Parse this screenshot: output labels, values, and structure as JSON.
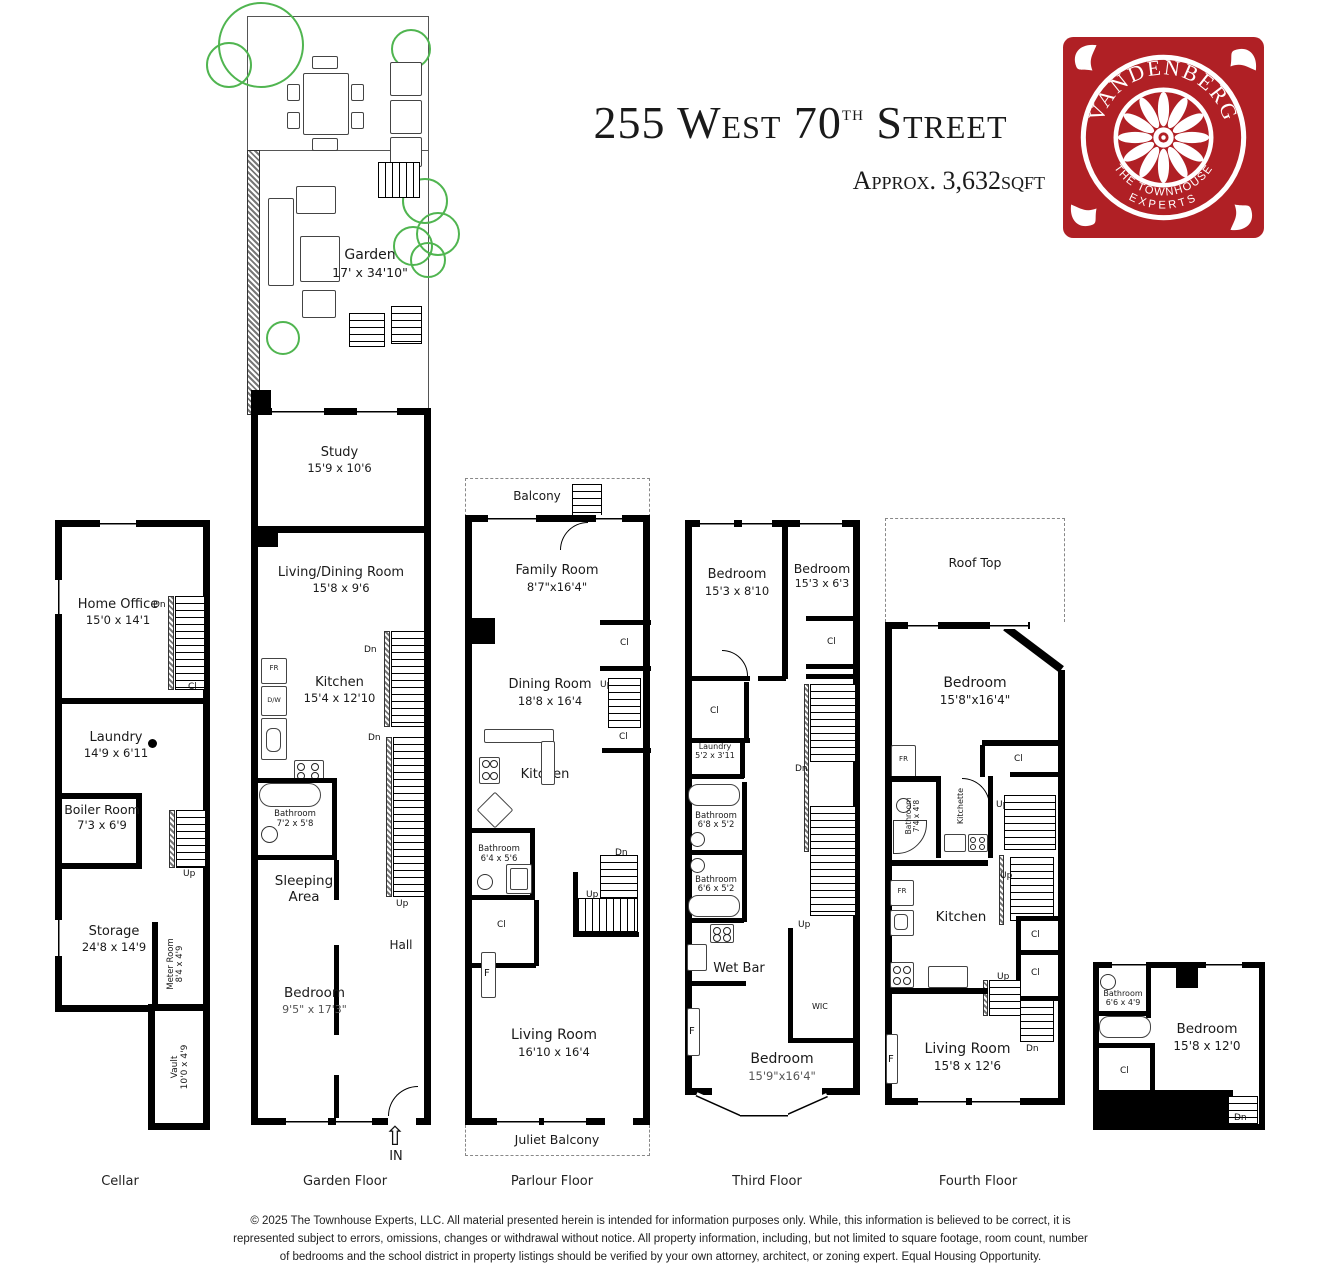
{
  "header": {
    "title_num": "255 West 70",
    "title_sup": "th",
    "title_rest": " Street",
    "subtitle": "Approx. 3,632sqft"
  },
  "logo": {
    "brand": "VANDENBERG",
    "tagline_top": "THE TOWNHOUSE",
    "tagline_bottom": "EXPERTS",
    "bg": "#b02025"
  },
  "garden": {
    "name": "Garden",
    "dims": "17' x 34'10\""
  },
  "labels": {
    "dn": "Dn",
    "up": "Up",
    "cl": "Cl",
    "f": "F",
    "fr": "FR",
    "dw": "D/W",
    "wic": "WIC",
    "entry": "IN"
  },
  "icons": {
    "entry_arrow": "⇧"
  },
  "cellar": {
    "floor_label": "Cellar",
    "home_office": {
      "n": "Home Office",
      "d": "15'0 x 14'1"
    },
    "laundry": {
      "n": "Laundry",
      "d": "14'9 x 6'11"
    },
    "boiler": {
      "n": "Boiler Room",
      "d": "7'3 x 6'9"
    },
    "storage": {
      "n": "Storage",
      "d": "24'8 x 14'9"
    },
    "meter": {
      "n": "Meter Room",
      "d": "8'4 x 4'9"
    },
    "vault": {
      "n": "Vault",
      "d": "10'0 x 4'9"
    }
  },
  "garden_floor": {
    "floor_label": "Garden Floor",
    "study": {
      "n": "Study",
      "d": "15'9 x 10'6"
    },
    "living_dining": {
      "n": "Living/Dining Room",
      "d": "15'8 x 9'6"
    },
    "kitchen": {
      "n": "Kitchen",
      "d": "15'4 x 12'10"
    },
    "bathroom": {
      "n": "Bathroom",
      "d": "7'2 x 5'8"
    },
    "sleeping": {
      "l1": "Sleeping",
      "l2": "Area"
    },
    "bedroom": {
      "n": "Bedroom",
      "d": "9'5\" x 17'3\""
    },
    "hall": "Hall"
  },
  "parlour": {
    "floor_label": "Parlour Floor",
    "balcony": "Balcony",
    "family": {
      "n": "Family Room",
      "d": "8'7\"x16'4\""
    },
    "dining": {
      "n": "Dining Room",
      "d": "18'8 x 16'4"
    },
    "kitchen": "Kitchen",
    "bathroom": {
      "n": "Bathroom",
      "d": "6'4 x 5'6"
    },
    "living": {
      "n": "Living Room",
      "d": "16'10 x 16'4"
    },
    "juliet": "Juliet Balcony"
  },
  "third": {
    "floor_label": "Third Floor",
    "bedroom1": {
      "n": "Bedroom",
      "d": "15'3 x 8'10"
    },
    "bedroom2": {
      "n": "Bedroom",
      "d": "15'3 x 6'3"
    },
    "laundry": {
      "n": "Laundry",
      "d": "5'2 x 3'11"
    },
    "bathroom1": {
      "n": "Bathroom",
      "d": "6'8 x 5'2"
    },
    "bathroom2": {
      "n": "Bathroom",
      "d": "6'6 x 5'2"
    },
    "wet_bar": "Wet Bar",
    "bedroom3": {
      "n": "Bedroom",
      "d": "15'9\"x16'4\""
    }
  },
  "fourth": {
    "floor_label": "Fourth Floor",
    "roof": "Roof Top",
    "bedroom": {
      "n": "Bedroom",
      "d": "15'8\"x16'4\""
    },
    "bathroom": {
      "n": "Bathroom",
      "d": "7'4 x 4'8"
    },
    "kitchette": "Kitchette",
    "kitchen": "Kitchen",
    "living": {
      "n": "Living Room",
      "d": "15'8 x 12'6"
    }
  },
  "fifth": {
    "bathroom": {
      "n": "Bathroom",
      "d": "6'6 x 4'9"
    },
    "bedroom": {
      "n": "Bedroom",
      "d": "15'8 x 12'0"
    }
  },
  "footer": {
    "line1": "© 2025 The Townhouse Experts, LLC. All material presented herein is intended for information purposes only. While, this information is believed to be correct, it is",
    "line2": "represented subject to errors, omissions, changes or withdrawal without notice. All property information, including, but not limited to square footage, room count, number",
    "line3": "of bedrooms and the school district in property listings should be verified by your own attorney, architect, or zoning expert. Equal Housing Opportunity."
  }
}
